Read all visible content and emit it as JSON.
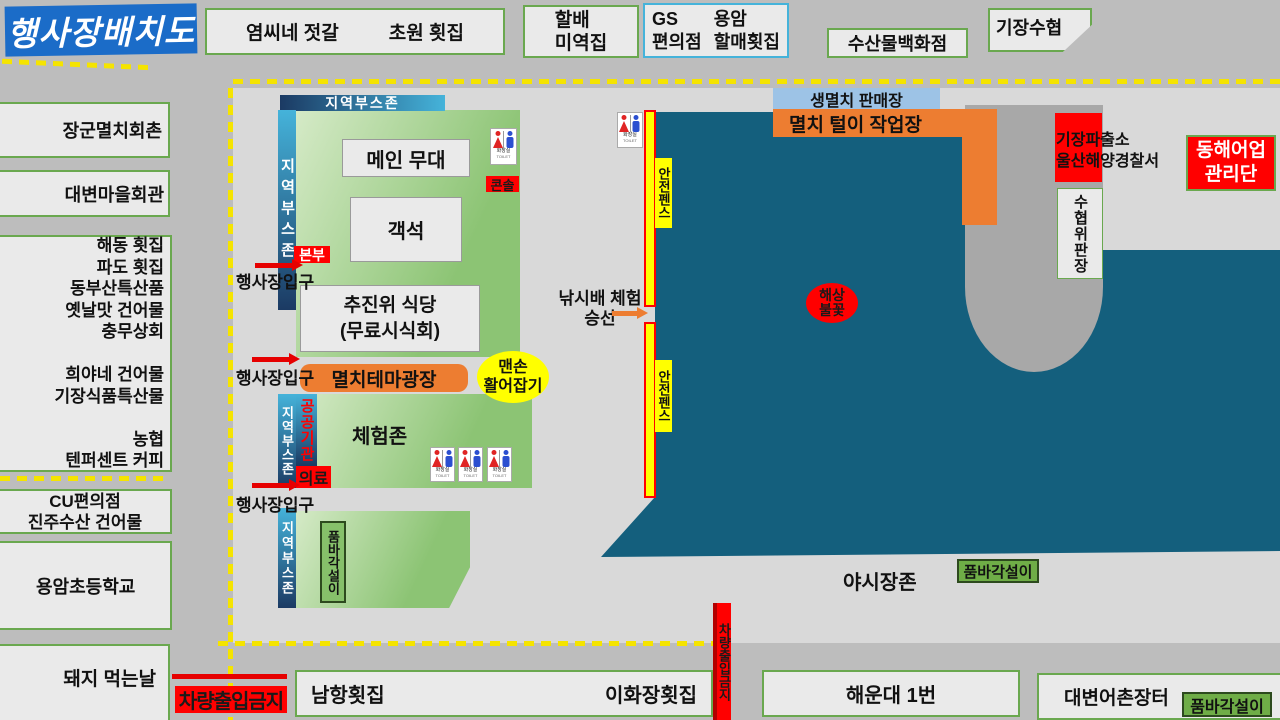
{
  "title": "행사장배치도",
  "top_shops": {
    "yeomssi": "염씨네 젓갈",
    "chowon": "초원 횟집",
    "halbae": "할배\n미역집",
    "gs_store": "GS\n편의점",
    "yongam_hoetjip": "용암\n할매횟집",
    "fish_department": "수산물백화점",
    "gijang_suhyup": "기장수협"
  },
  "left_shops": {
    "janggun": "장군멸치회촌",
    "village_hall": "대변마을회관",
    "shop_list": "해동 횟집\n파도 횟집\n동부산특산품\n옛날맛 건어물\n충무상회\n\n희야네 건어물\n기장식품특산물\n\n농협\n텐퍼센트 커피",
    "cu": "CU편의점\n진주수산 건어물",
    "yongam_school": "용암초등학교",
    "pig_day": "돼지 먹는날"
  },
  "zones": {
    "local_booth": "지역부스존",
    "hq": "본부",
    "entrance": "행사장입구",
    "main_stage": "메인 무대",
    "seats": "객석",
    "console": "콘솔",
    "committee_dining": "추진위 식당\n(무료시식회)",
    "theme_plaza": "멸치테마광장",
    "bare_hand": "맨손\n활어잡기",
    "public_org": "공공기관",
    "medical": "의료",
    "experience": "체험존",
    "pumba": "품바각설이"
  },
  "harbor": {
    "safety_fence": "안전펜스",
    "fishing_boat": "낚시배 체험\n승선",
    "anchovy_sale": "생멸치 판매장",
    "anchovy_work": "멸치 털이 작업장",
    "sea_fireworks": "해상\n불꽃",
    "police": "기장파출소\n울산해양경찰서",
    "donghae_fishery": "동해어업\n관리단",
    "suhyup_market": "수협위판장",
    "night_market": "야시장존"
  },
  "bottom": {
    "no_vehicle": "차량출입금지",
    "namhang": "남항횟집",
    "ihwajang": "이화장횟집",
    "haeundae": "해운대 1번",
    "daebyeon_market": "대변어촌장터"
  },
  "toilet": {
    "label": "화장실",
    "label_en": "TOILET"
  },
  "colors": {
    "sea": "#145f7d",
    "road": "#bdbdbd",
    "ground": "#d9d9d9",
    "zone_green": "#8cc474",
    "booth_blue_light": "#45b3da",
    "booth_blue_dark": "#1b3a63",
    "orange": "#ed7d31",
    "alert_red": "#ff0000",
    "fence_yellow": "#ffff00",
    "sale_blue": "#9dc3e6",
    "title_blue": "#1b6cc8",
    "box_border_green": "#6aa84f"
  }
}
